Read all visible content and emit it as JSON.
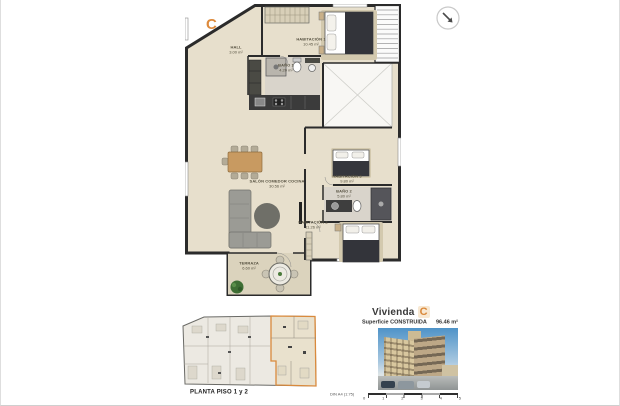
{
  "unit": {
    "letter": "C"
  },
  "floor_plan": {
    "rooms": [
      {
        "name": "HALL",
        "area": "3.00 m²"
      },
      {
        "name": "HABITACIÓN 1",
        "area": "10.45 m²"
      },
      {
        "name": "BAÑO 1",
        "area": "4.20 m²"
      },
      {
        "name": "SALÓN COMEDOR COCINA",
        "area": "30.56 m²"
      },
      {
        "name": "HABITACIÓN 3",
        "area": "9.80 m²"
      },
      {
        "name": "BAÑO 2",
        "area": "5.80 m²"
      },
      {
        "name": "HABITACIÓN 2",
        "area": "11.26 m²"
      },
      {
        "name": "TERRAZA",
        "area": "6.60 m²"
      }
    ]
  },
  "key_plan": {
    "caption": "PLANTA PISO 1 y 2"
  },
  "title_block": {
    "dwelling_label": "Vivienda",
    "unit_letter": "C",
    "surface_label": "Superficie CONSTRUIDA",
    "surface_value": "96.46 m²"
  },
  "scale_bar": {
    "label": "DIN A4 (1:75)",
    "ticks": [
      "0",
      "1",
      "2",
      "3",
      "4",
      "5"
    ]
  },
  "icons": {
    "north_arrow": "north-arrow-icon"
  },
  "colors": {
    "accent_orange": "#dd8a3c",
    "floor_beige": "#e7dfcc",
    "wall_dark": "#2b2b2b"
  }
}
